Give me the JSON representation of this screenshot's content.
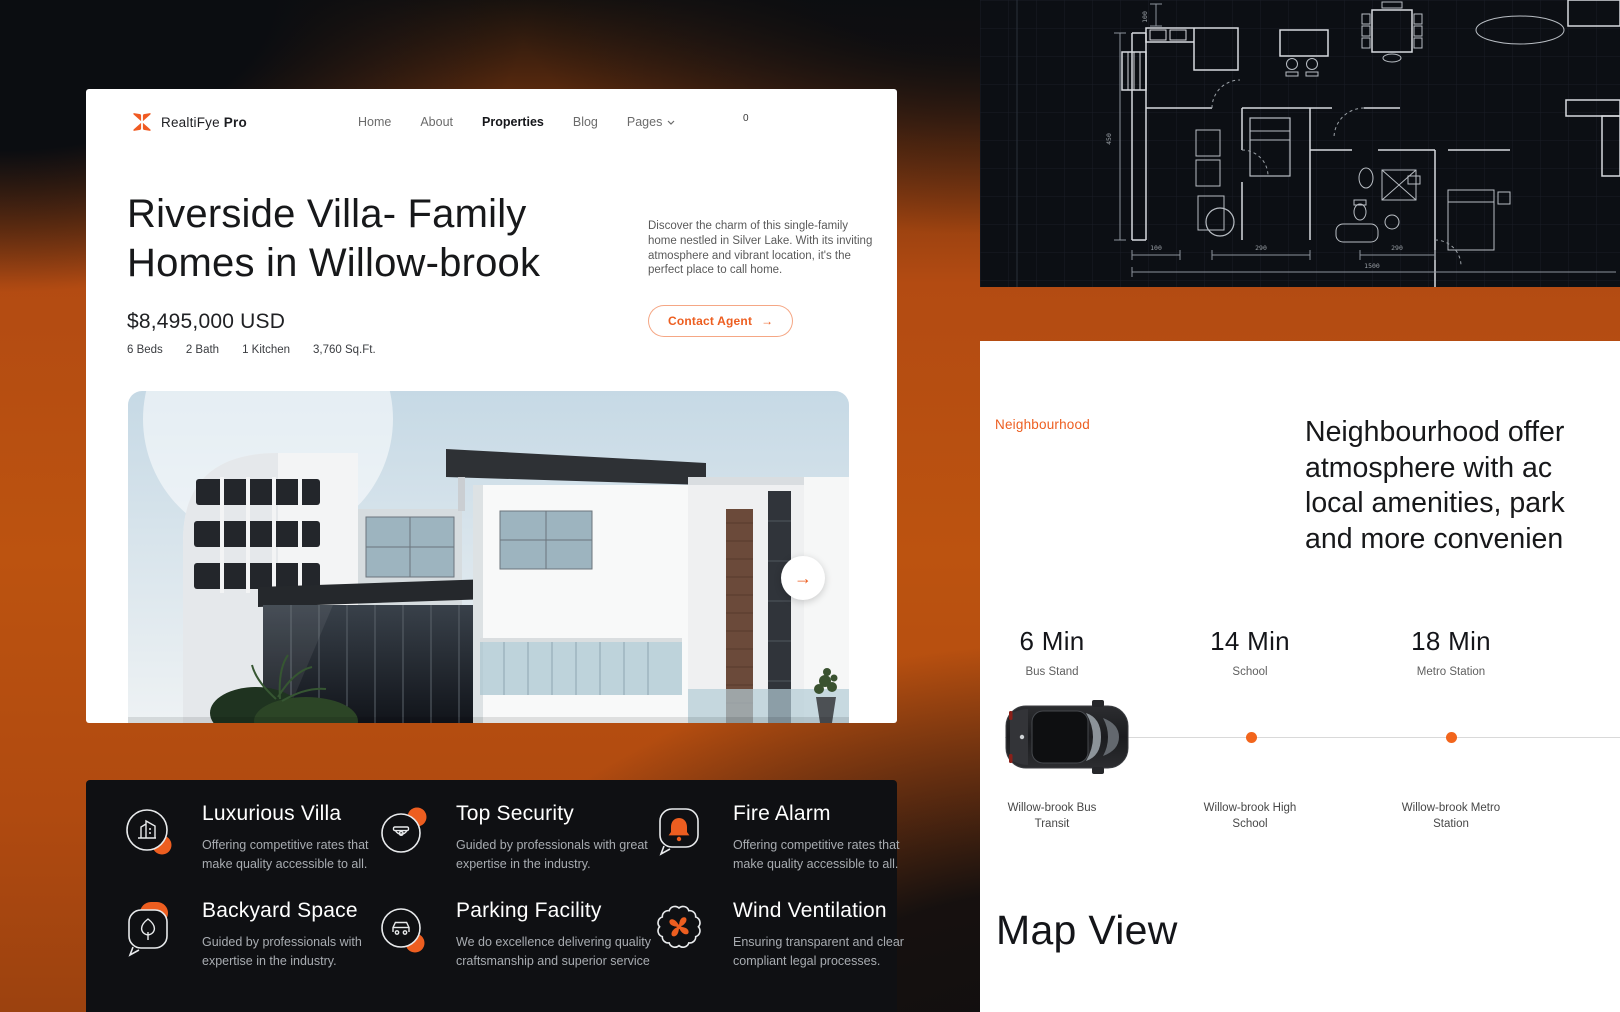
{
  "brand": {
    "name": "RealtiFye",
    "suffix": "Pro"
  },
  "nav": {
    "items": [
      "Home",
      "About",
      "Properties",
      "Blog",
      "Pages"
    ],
    "active": "Properties",
    "cart_count": "0"
  },
  "hero": {
    "title_line1": "Riverside Villa- Family",
    "title_line2": "Homes in Willow-brook",
    "price": "$8,495,000 USD",
    "stats": [
      "6 Beds",
      "2 Bath",
      "1 Kitchen",
      "3,760 Sq.Ft."
    ],
    "description_lines": [
      "Discover the charm of this single-family",
      "home nestled in Silver Lake. With its inviting",
      "atmosphere and vibrant location, it's the",
      "perfect place to call home."
    ],
    "cta_label": "Contact Agent",
    "cta_arrow": "→",
    "next_arrow": "→"
  },
  "features": [
    {
      "icon": "building-icon",
      "title": "Luxurious Villa",
      "desc": "Offering competitive rates that make quality accessible to all."
    },
    {
      "icon": "security-camera-icon",
      "title": "Top Security",
      "desc": "Guided by professionals with great expertise in the industry."
    },
    {
      "icon": "alarm-bell-icon",
      "title": "Fire Alarm",
      "desc": "Offering competitive rates that make quality accessible to all."
    },
    {
      "icon": "tree-icon",
      "title": "Backyard Space",
      "desc": "Guided by professionals with expertise in the industry."
    },
    {
      "icon": "car-icon",
      "title": "Parking Facility",
      "desc": "We do excellence delivering quality craftsmanship and superior service"
    },
    {
      "icon": "fan-icon",
      "title": "Wind Ventilation",
      "desc": "Ensuring transparent and clear compliant legal processes."
    }
  ],
  "neighbourhood": {
    "label": "Neighbourhood",
    "heading_lines": [
      "Neighbourhood offer",
      "atmosphere with ac",
      "local amenities, park",
      "and more convenien"
    ],
    "stops": [
      {
        "time": "6 Min",
        "place": "Bus Stand",
        "station_line1": "Willow-brook Bus",
        "station_line2": "Transit"
      },
      {
        "time": "14 Min",
        "place": "School",
        "station_line1": "Willow-brook High",
        "station_line2": "School"
      },
      {
        "time": "18 Min",
        "place": "Metro Station",
        "station_line1": "Willow-brook Metro",
        "station_line2": "Station"
      }
    ],
    "map_heading": "Map View"
  },
  "blueprint": {
    "dims": {
      "top": "100",
      "left": "450",
      "b1": "100",
      "b2": "290",
      "b3": "290",
      "total": "1500"
    }
  },
  "colors": {
    "accent": "#ED5E20",
    "band_orange": "#B34B12",
    "dark_card": "#0F1013",
    "page_dark": "#0B0D11"
  }
}
